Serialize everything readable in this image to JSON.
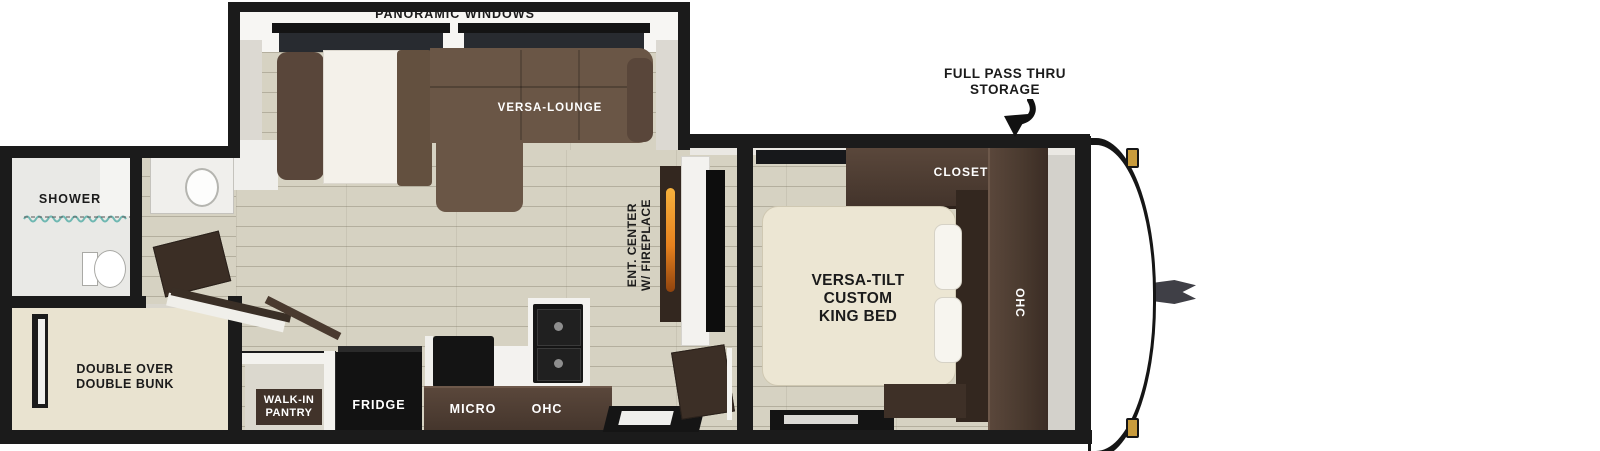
{
  "floorplan": {
    "slideout": {
      "pano": "PANORAMIC WINDOWS",
      "lounge": "VERSA-LOUNGE"
    },
    "callout": {
      "l1": "FULL PASS THRU",
      "l2": "STORAGE"
    },
    "bedroom": {
      "closet": "CLOSET",
      "ohc": "OHC",
      "bed1": "VERSA-TILT",
      "bed2": "CUSTOM",
      "bed3": "KING BED"
    },
    "bathroom": {
      "shower": "SHOWER"
    },
    "bunkroom": {
      "l1": "DOUBLE OVER",
      "l2": "DOUBLE BUNK"
    },
    "kitchen": {
      "pantry1": "WALK-IN",
      "pantry2": "PANTRY",
      "fridge": "FRIDGE",
      "micro": "MICRO",
      "ohc": "OHC"
    },
    "entertainment": {
      "l1": "ENT. CENTER",
      "l2": "W/ FIREPLACE"
    },
    "colors": {
      "wall": "#1b1b1b",
      "floor": "#d6d2c2",
      "dark_wood": "#46362c",
      "sofa_brown": "#6a5646",
      "bed_cream": "#ece6d3",
      "flame_orange": "#e8821e",
      "marker_amber": "#c89b3c",
      "label_dark": "#1b1b1b",
      "label_light": "#ffffff"
    }
  }
}
